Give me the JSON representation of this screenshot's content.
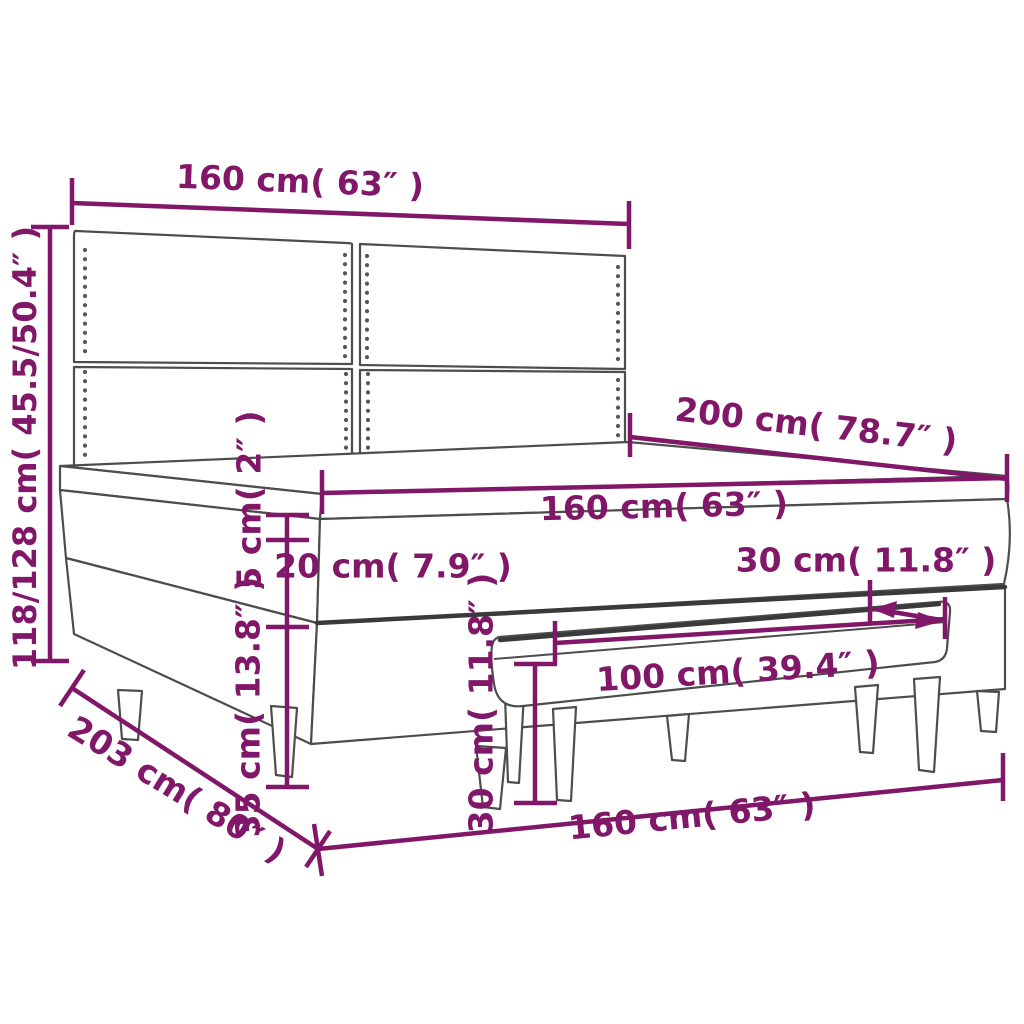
{
  "colors": {
    "accent": "#801768",
    "outline": "#4d4d4d",
    "outline_dark": "#3a3a3a",
    "background": "#ffffff"
  },
  "dimensions": {
    "headboard_width": {
      "label": "160 cm( 63″ )"
    },
    "overall_height": {
      "label": "118/128 cm( 45.5/50.4″ )"
    },
    "bed_length": {
      "label": "200 cm( 78.7″ )"
    },
    "mattress_width": {
      "label": "160 cm( 63″ )"
    },
    "topper_thickness": {
      "label": "5 cm( 2″ )"
    },
    "mattress_thickness": {
      "label": "20 cm( 7.9″ )"
    },
    "base_height": {
      "label": "35 cm( 13.8″ )"
    },
    "bench_depth": {
      "label": "30 cm( 11.8″ )"
    },
    "bench_height": {
      "label": "30 cm( 11.8″ )"
    },
    "bench_length": {
      "label": "100 cm( 39.4″ )"
    },
    "overall_length": {
      "label": "203 cm( 80″ )"
    },
    "frame_width": {
      "label": "160 cm( 63″ )"
    }
  }
}
